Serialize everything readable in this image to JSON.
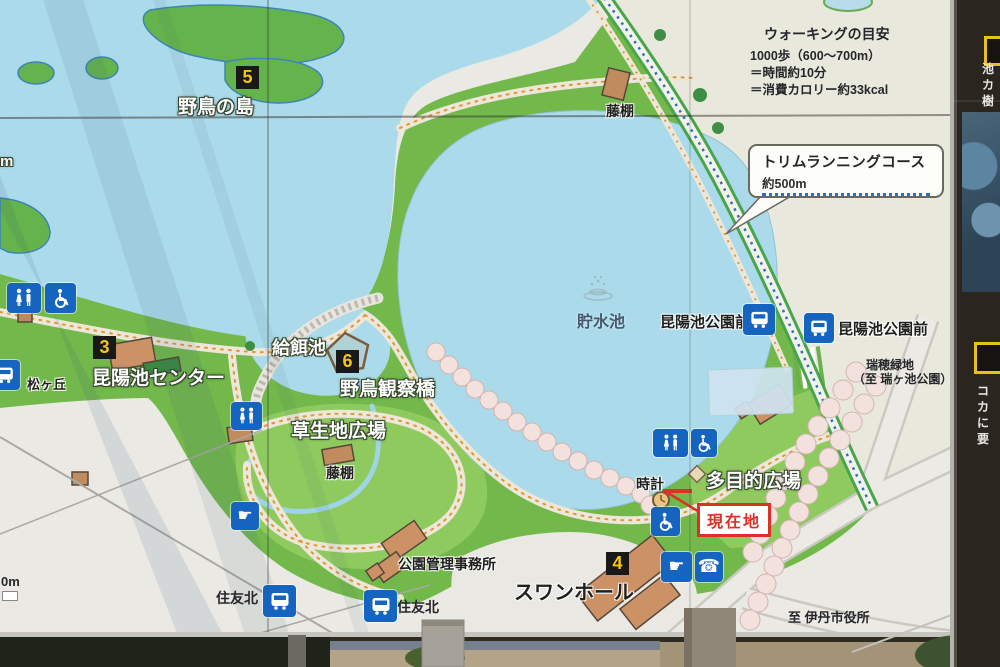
{
  "sign": {
    "walking_info": {
      "title": "ウォーキングの目安",
      "line1": "1000歩（600〜700m）",
      "line2": "＝時間約10分",
      "line3": "＝消費カロリー約33kcal"
    },
    "callout": {
      "title": "トリムランニングコース",
      "distance": "約500m"
    },
    "current_location_label": "現在地",
    "badges": {
      "b3": "3",
      "b4": "4",
      "b5": "5",
      "b6": "6"
    },
    "labels": {
      "bird_island": "野鳥の島",
      "feeding_pond": "給餌池",
      "koyaike_center": "昆陽池センター",
      "matsugaoka": "松ヶ丘",
      "bird_observation_bridge": "野鳥観察橋",
      "grass_plaza": "草生地広場",
      "wisteria_trellis_north": "藤棚",
      "wisteria_trellis_south": "藤棚",
      "reservoir": "貯水池",
      "bus_stop_koyaike_park_front_west": "昆陽池公園前",
      "bus_stop_koyaike_park_front_east": "昆陽池公園前",
      "mizuho_ryokuchi": "瑞穂緑地",
      "to_mizugaike_park": "（至 瑞ヶ池公園）",
      "multipurpose_plaza": "多目的広場",
      "clock": "時計",
      "swan_hall": "スワンホール",
      "park_office": "公園管理事務所",
      "sumitomo_kita_west": "住友北",
      "sumitomo_kita_east": "住友北",
      "to_itami_city_hall": "至 伊丹市役所",
      "scale_partial": "0m",
      "left_edge_partial": "m"
    },
    "side_panel": {
      "top_chars": [
        "池",
        "カ",
        "樹"
      ],
      "bottom_chars": [
        "コ",
        "カ",
        "に",
        "要"
      ]
    },
    "icons": {
      "fountain_glyph": "☛",
      "phone_glyph": "☎"
    }
  },
  "colors": {
    "park_green": "#72b84b",
    "light_green": "#8fca5e",
    "water_blue": "#abdbea",
    "icon_blue": "#1565c0",
    "badge_bg": "#191919",
    "badge_number": "#f3c614",
    "course_green": "#49a54d",
    "course_dot_blue": "#2a6fc0",
    "accent_red": "#dd3128"
  }
}
